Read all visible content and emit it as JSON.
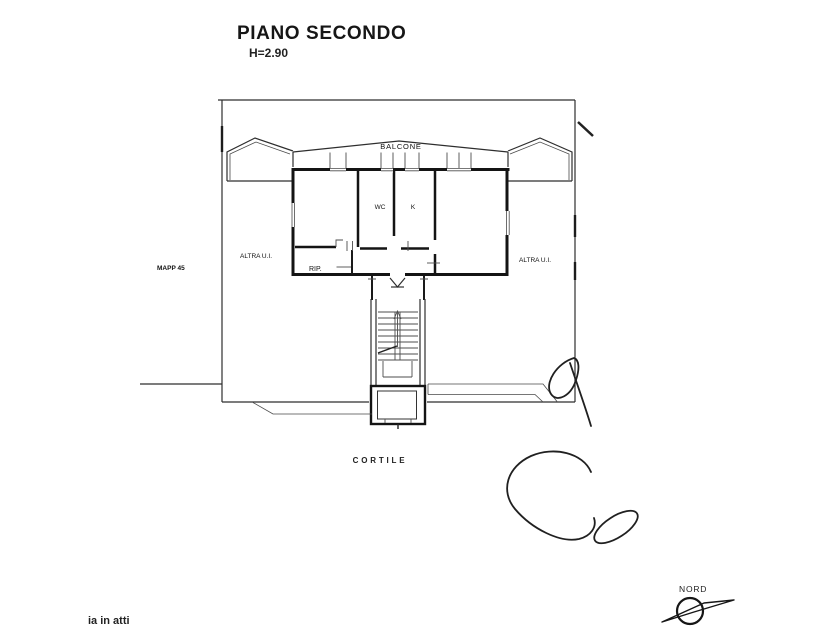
{
  "page": {
    "background": "#ffffff",
    "ink": "#1a1a1a"
  },
  "header": {
    "title": "PIANO SECONDO",
    "height_label": "H=2.90"
  },
  "floor_plan": {
    "labels": {
      "balcony": "BALCONE",
      "wc": "WC",
      "kitchen": "K",
      "storage": "RIP.",
      "left_unit": "ALTRA U.I.",
      "right_unit": "ALTRA U.I.",
      "parcel": "MAPP 45",
      "courtyard": "CORTILE"
    }
  },
  "compass": {
    "label": "NORD"
  },
  "footer": {
    "clipped_text": "ia in atti"
  }
}
